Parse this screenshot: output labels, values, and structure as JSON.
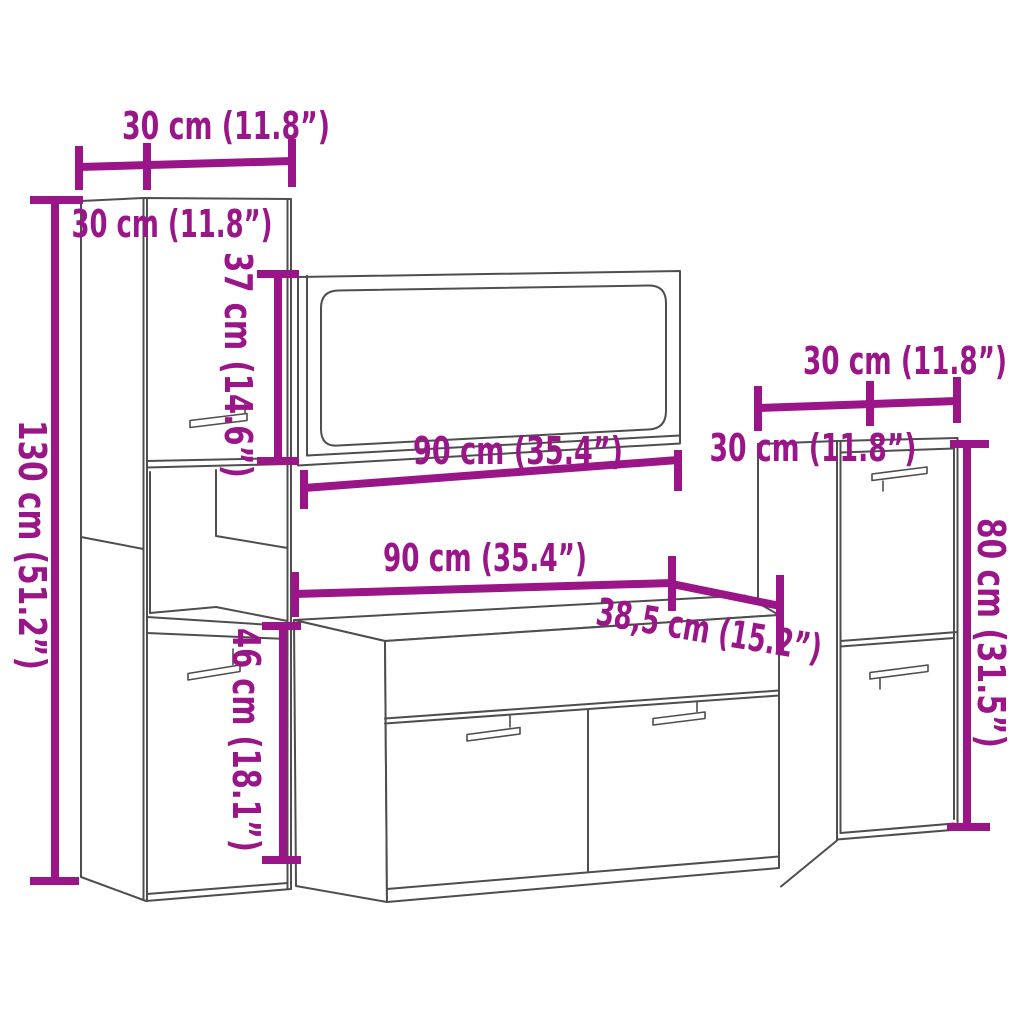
{
  "dims": {
    "tall_width": "30 cm (11.8”)",
    "tall_depth": "30 cm (11.8”)",
    "tall_height": "130 cm (51.2”)",
    "tall_upper": "37 cm (14.6”)",
    "tall_lower": "46 cm (18.1”)",
    "mirror_width": "90 cm (35.4”)",
    "vanity_width": "90 cm (35.4”)",
    "vanity_depth": "38,5 cm (15.2”)",
    "wall_width": "30 cm (11.8”)",
    "wall_depth": "30 cm (11.8”)",
    "wall_height": "80 cm (31.5”)"
  },
  "colors": {
    "dimension": "#9A1688",
    "outline": "#4E4E4E",
    "background": "#FFFFFF"
  }
}
